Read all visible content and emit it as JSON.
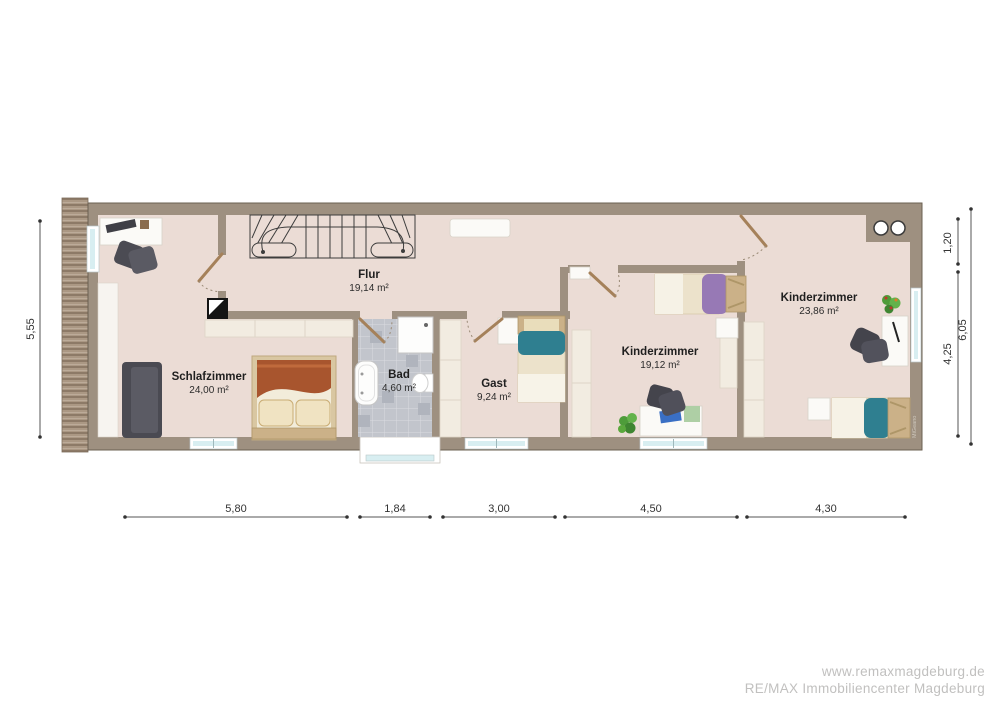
{
  "plan": {
    "type": "floorplan",
    "floor_mark": "MiGeano",
    "rooms": {
      "flur": {
        "name": "Flur",
        "area": "19,14 m²"
      },
      "schlafzimmer": {
        "name": "Schlafzimmer",
        "area": "24,00 m²"
      },
      "bad": {
        "name": "Bad",
        "area": "4,60 m²"
      },
      "gast": {
        "name": "Gast",
        "area": "9,24 m²"
      },
      "kinderzimmer1": {
        "name": "Kinderzimmer",
        "area": "19,12 m²"
      },
      "kinderzimmer2": {
        "name": "Kinderzimmer",
        "area": "23,86 m²"
      }
    },
    "dimensions": {
      "bottom": [
        "5,80",
        "1,84",
        "3,00",
        "4,50",
        "4,30"
      ],
      "left": "5,55",
      "right_segments": [
        "1,20",
        "4,25"
      ],
      "right_total": "6,05"
    }
  },
  "watermark": {
    "line1": "www.remaxmagdeburg.de",
    "line2": "RE/MAX Immobiliencenter Magdeburg"
  },
  "colors": {
    "floor": "#ebdcd5",
    "wall": "#9e9080",
    "window_glass": "#d8eef1",
    "bath_tile": "#c2c5cc",
    "accent_rust": "#a8552e",
    "accent_teal": "#2f7f90",
    "accent_purple": "#9779b5",
    "furniture_dark": "#4a4a52",
    "wood": "#cbb188"
  }
}
